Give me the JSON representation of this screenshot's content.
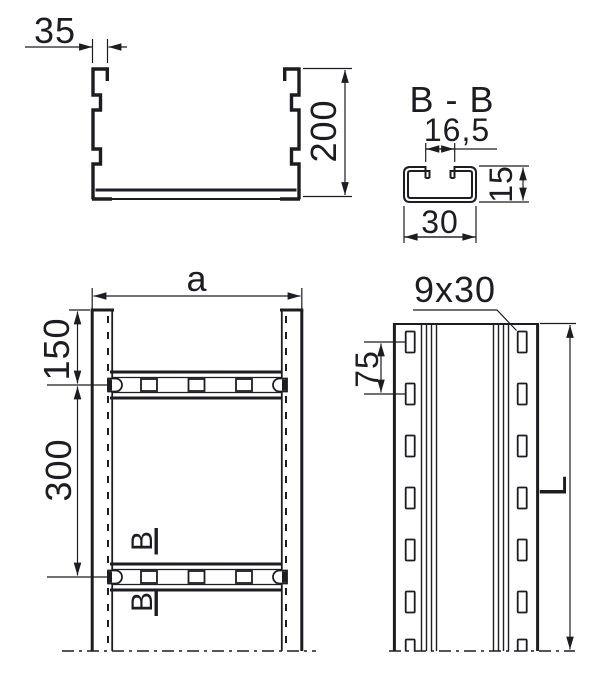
{
  "colors": {
    "line": "#1c1c22",
    "background": "#ffffff"
  },
  "views": {
    "front_section": {
      "flange_width": "35",
      "height": "200"
    },
    "rung_section": {
      "title": "B - B",
      "opening_width": "16,5",
      "height": "15",
      "width": "30"
    },
    "plan": {
      "overall_width": "a",
      "first_rung_offset": "150",
      "rung_pitch": "300",
      "section_cut_upper": "B",
      "section_cut_lower": "B"
    },
    "side": {
      "slot_size": "9x30",
      "slot_pitch": "75",
      "overall_length": "L"
    }
  }
}
